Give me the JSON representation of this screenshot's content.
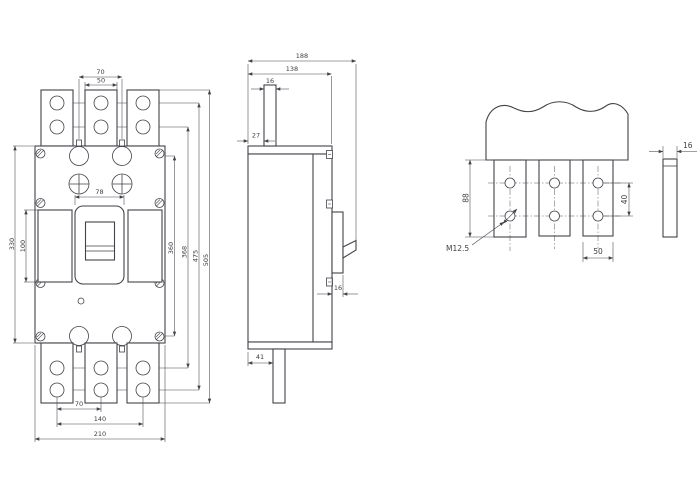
{
  "page": {
    "background": "#ffffff",
    "line_color": "#42424a",
    "description": "Dimensional outline drawing of a molded-case circuit breaker: front view, side view and terminal detail"
  },
  "front_view": {
    "dim_top_pitch": "70",
    "dim_top_tab_width": "50",
    "dim_handle_width": "78",
    "dim_window_height": "100",
    "dim_body_height": "330",
    "dim_screw_span": "360",
    "dim_inner_hole_span": "368",
    "dim_outer_hole_span": "475",
    "dim_overall_height": "505",
    "dim_bottom_hole_pitch": "70",
    "dim_bottom_hole_span": "140",
    "dim_overall_width": "210"
  },
  "side_view": {
    "dim_overall_depth": "188",
    "dim_body_depth": "138",
    "dim_top_tab_thickness": "16",
    "dim_top_tab_offset": "27",
    "dim_cover_step": "16",
    "dim_bottom_tab_offset": "41"
  },
  "terminal_detail": {
    "dim_tab_length": "88",
    "dim_hole_pitch": "40",
    "dim_tab_width": "50",
    "thread_label": "M12.5",
    "dim_tab_thickness": "16"
  }
}
